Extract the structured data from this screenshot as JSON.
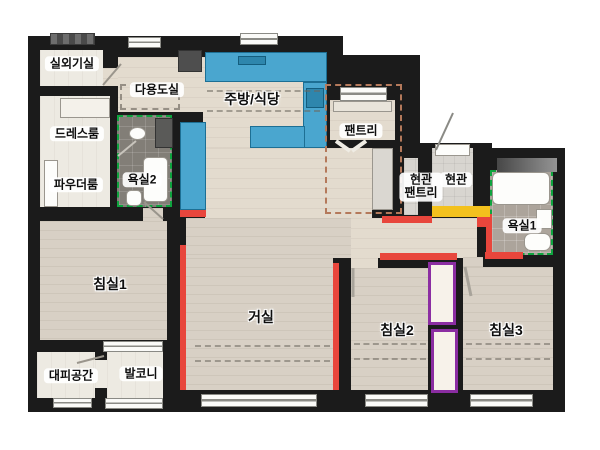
{
  "rooms": [
    {
      "id": "outdoor-unit-room",
      "label": "실외기실"
    },
    {
      "id": "utility-room",
      "label": "다용도실"
    },
    {
      "id": "kitchen-dining",
      "label": "주방/식당"
    },
    {
      "id": "dress-room",
      "label": "드레스룸"
    },
    {
      "id": "powder-room",
      "label": "파우더룸"
    },
    {
      "id": "bathroom-2",
      "label": "욕실2"
    },
    {
      "id": "pantry",
      "label": "팬트리"
    },
    {
      "id": "entry-pantry",
      "label": "현관 팬트리",
      "label_line1": "현관",
      "label_line2": "팬트리"
    },
    {
      "id": "entry",
      "label": "현관"
    },
    {
      "id": "bathroom-1",
      "label": "욕실1"
    },
    {
      "id": "bedroom-1",
      "label": "침실1"
    },
    {
      "id": "living-room",
      "label": "거실"
    },
    {
      "id": "bedroom-2",
      "label": "침실2"
    },
    {
      "id": "bedroom-3",
      "label": "침실3"
    },
    {
      "id": "refuge-area",
      "label": "대피공간"
    },
    {
      "id": "balcony",
      "label": "발코니"
    }
  ],
  "colors": {
    "wall": "#1b1b1b",
    "accent_red": "#e8463c",
    "counter_blue": "#4aa6cf",
    "counter_blue_dark": "#2e86ad",
    "entry_yellow": "#f3c11d",
    "closet_purple": "#8b2da2",
    "bath_dashed_green": "#0ea43e",
    "pantry_dashed_brown": "#b4795b",
    "floor_wood": "#d8d0c5",
    "floor_hall": "#e3dbce",
    "floor_light": "#edeae2",
    "tile_dark": "#827e77",
    "tile_light": "#aca49b",
    "window_frame": "#8a8a85"
  }
}
